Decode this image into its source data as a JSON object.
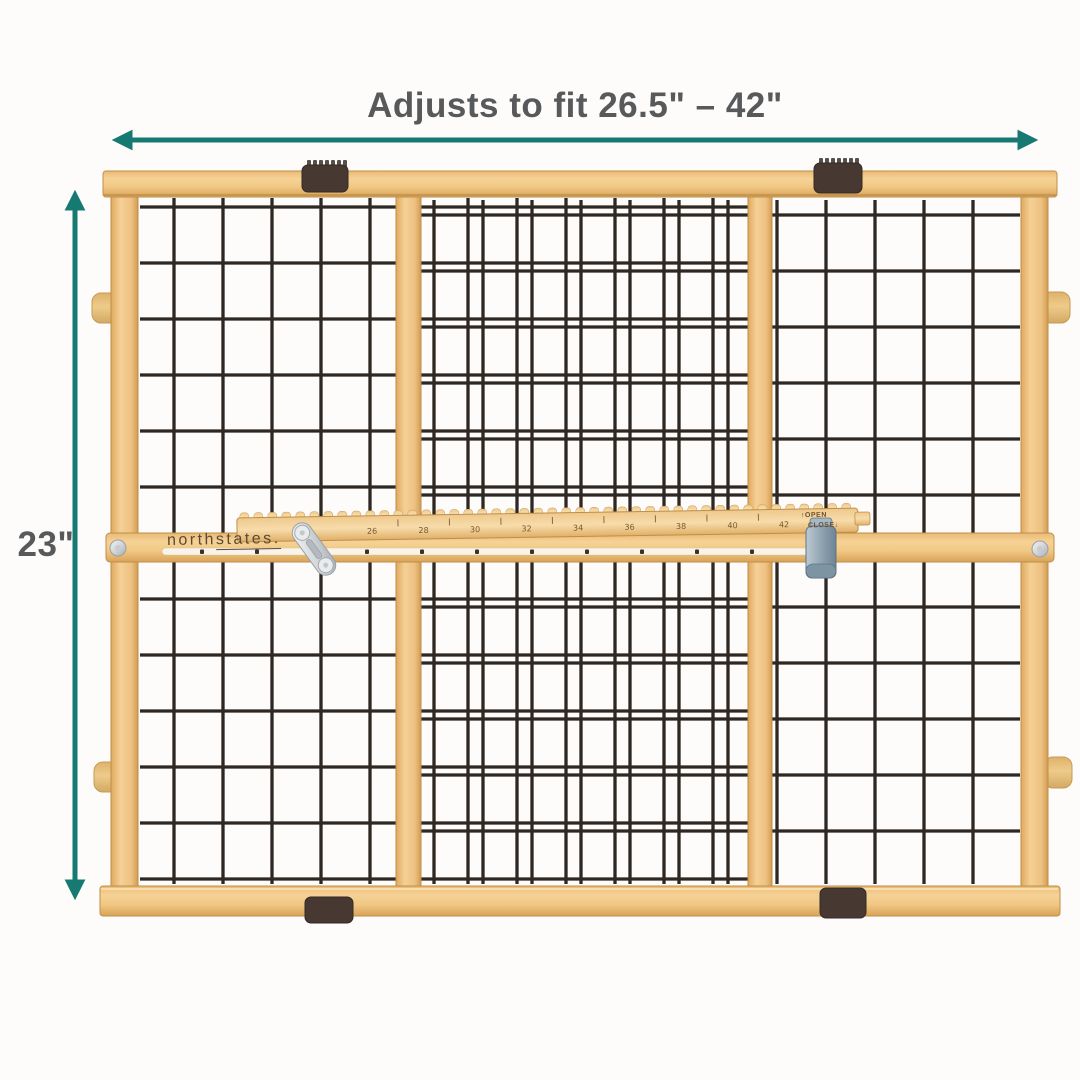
{
  "annotations": {
    "width_label": "Adjusts to fit 26.5\" – 42\"",
    "height_label": "23\""
  },
  "product": {
    "brand_part1": "north",
    "brand_part2": "states.",
    "ruler_numbers": [
      "26",
      "28",
      "30",
      "32",
      "34",
      "36",
      "38",
      "40",
      "42"
    ],
    "open_arrow": "↑",
    "open_label": "OPEN",
    "close_label": "CLOSE",
    "close_arrow": "↓"
  },
  "colors": {
    "accent_teal": "#177a72",
    "text_gray": "#58595a",
    "wood": "#f0c886",
    "wood_edge": "#c08e49",
    "wire": "#2e2722",
    "bracket_brown": "#473931",
    "logo_brown": "#5c4936",
    "metal_silver": "#ccd1d5",
    "clip_steel": "#8fa5b3",
    "knob_tan": "#e9c583",
    "background": "#fdfcfa"
  }
}
